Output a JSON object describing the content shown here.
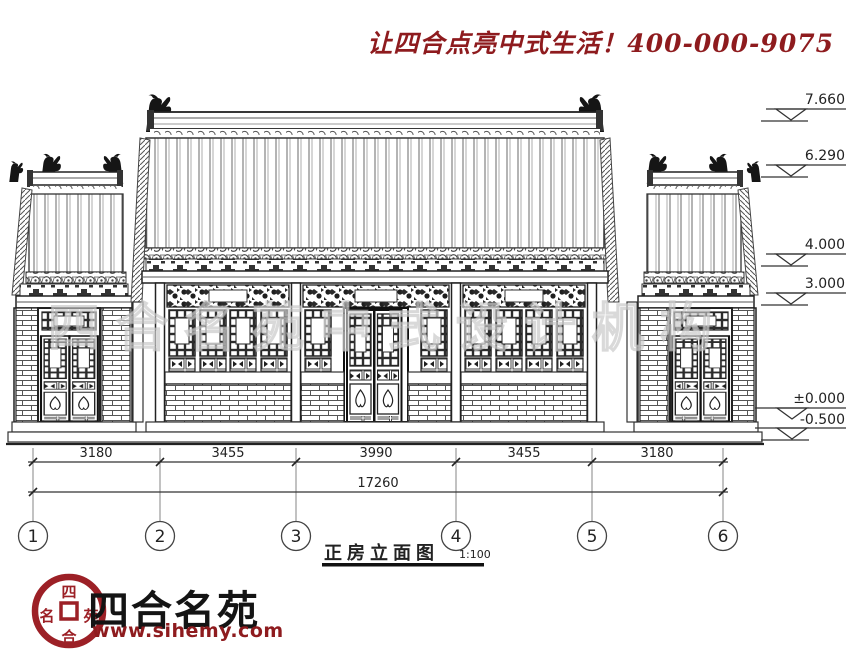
{
  "header": {
    "slogan": "让四合点亮中式生活！400-000-9075"
  },
  "watermark": "四合名苑中式设计机构",
  "drawing": {
    "title": "正房立面图",
    "scale": "1:100",
    "elevation_markers": [
      "7.660",
      "6.290",
      "4.000",
      "3.000",
      "±0.000",
      "-0.500"
    ],
    "axis_labels": [
      "1",
      "2",
      "3",
      "4",
      "5",
      "6"
    ],
    "dimensions": {
      "segments": [
        "3180",
        "3455",
        "3990",
        "3455",
        "3180"
      ],
      "total": "17260"
    }
  },
  "footer": {
    "brand": "四合名苑",
    "website": "www.sihemy.com",
    "seal": {
      "top": "四",
      "bottom": "合",
      "left": "名",
      "right": "苑"
    }
  },
  "colors": {
    "accent_red": "#8e1b1e",
    "line": "#222222"
  }
}
